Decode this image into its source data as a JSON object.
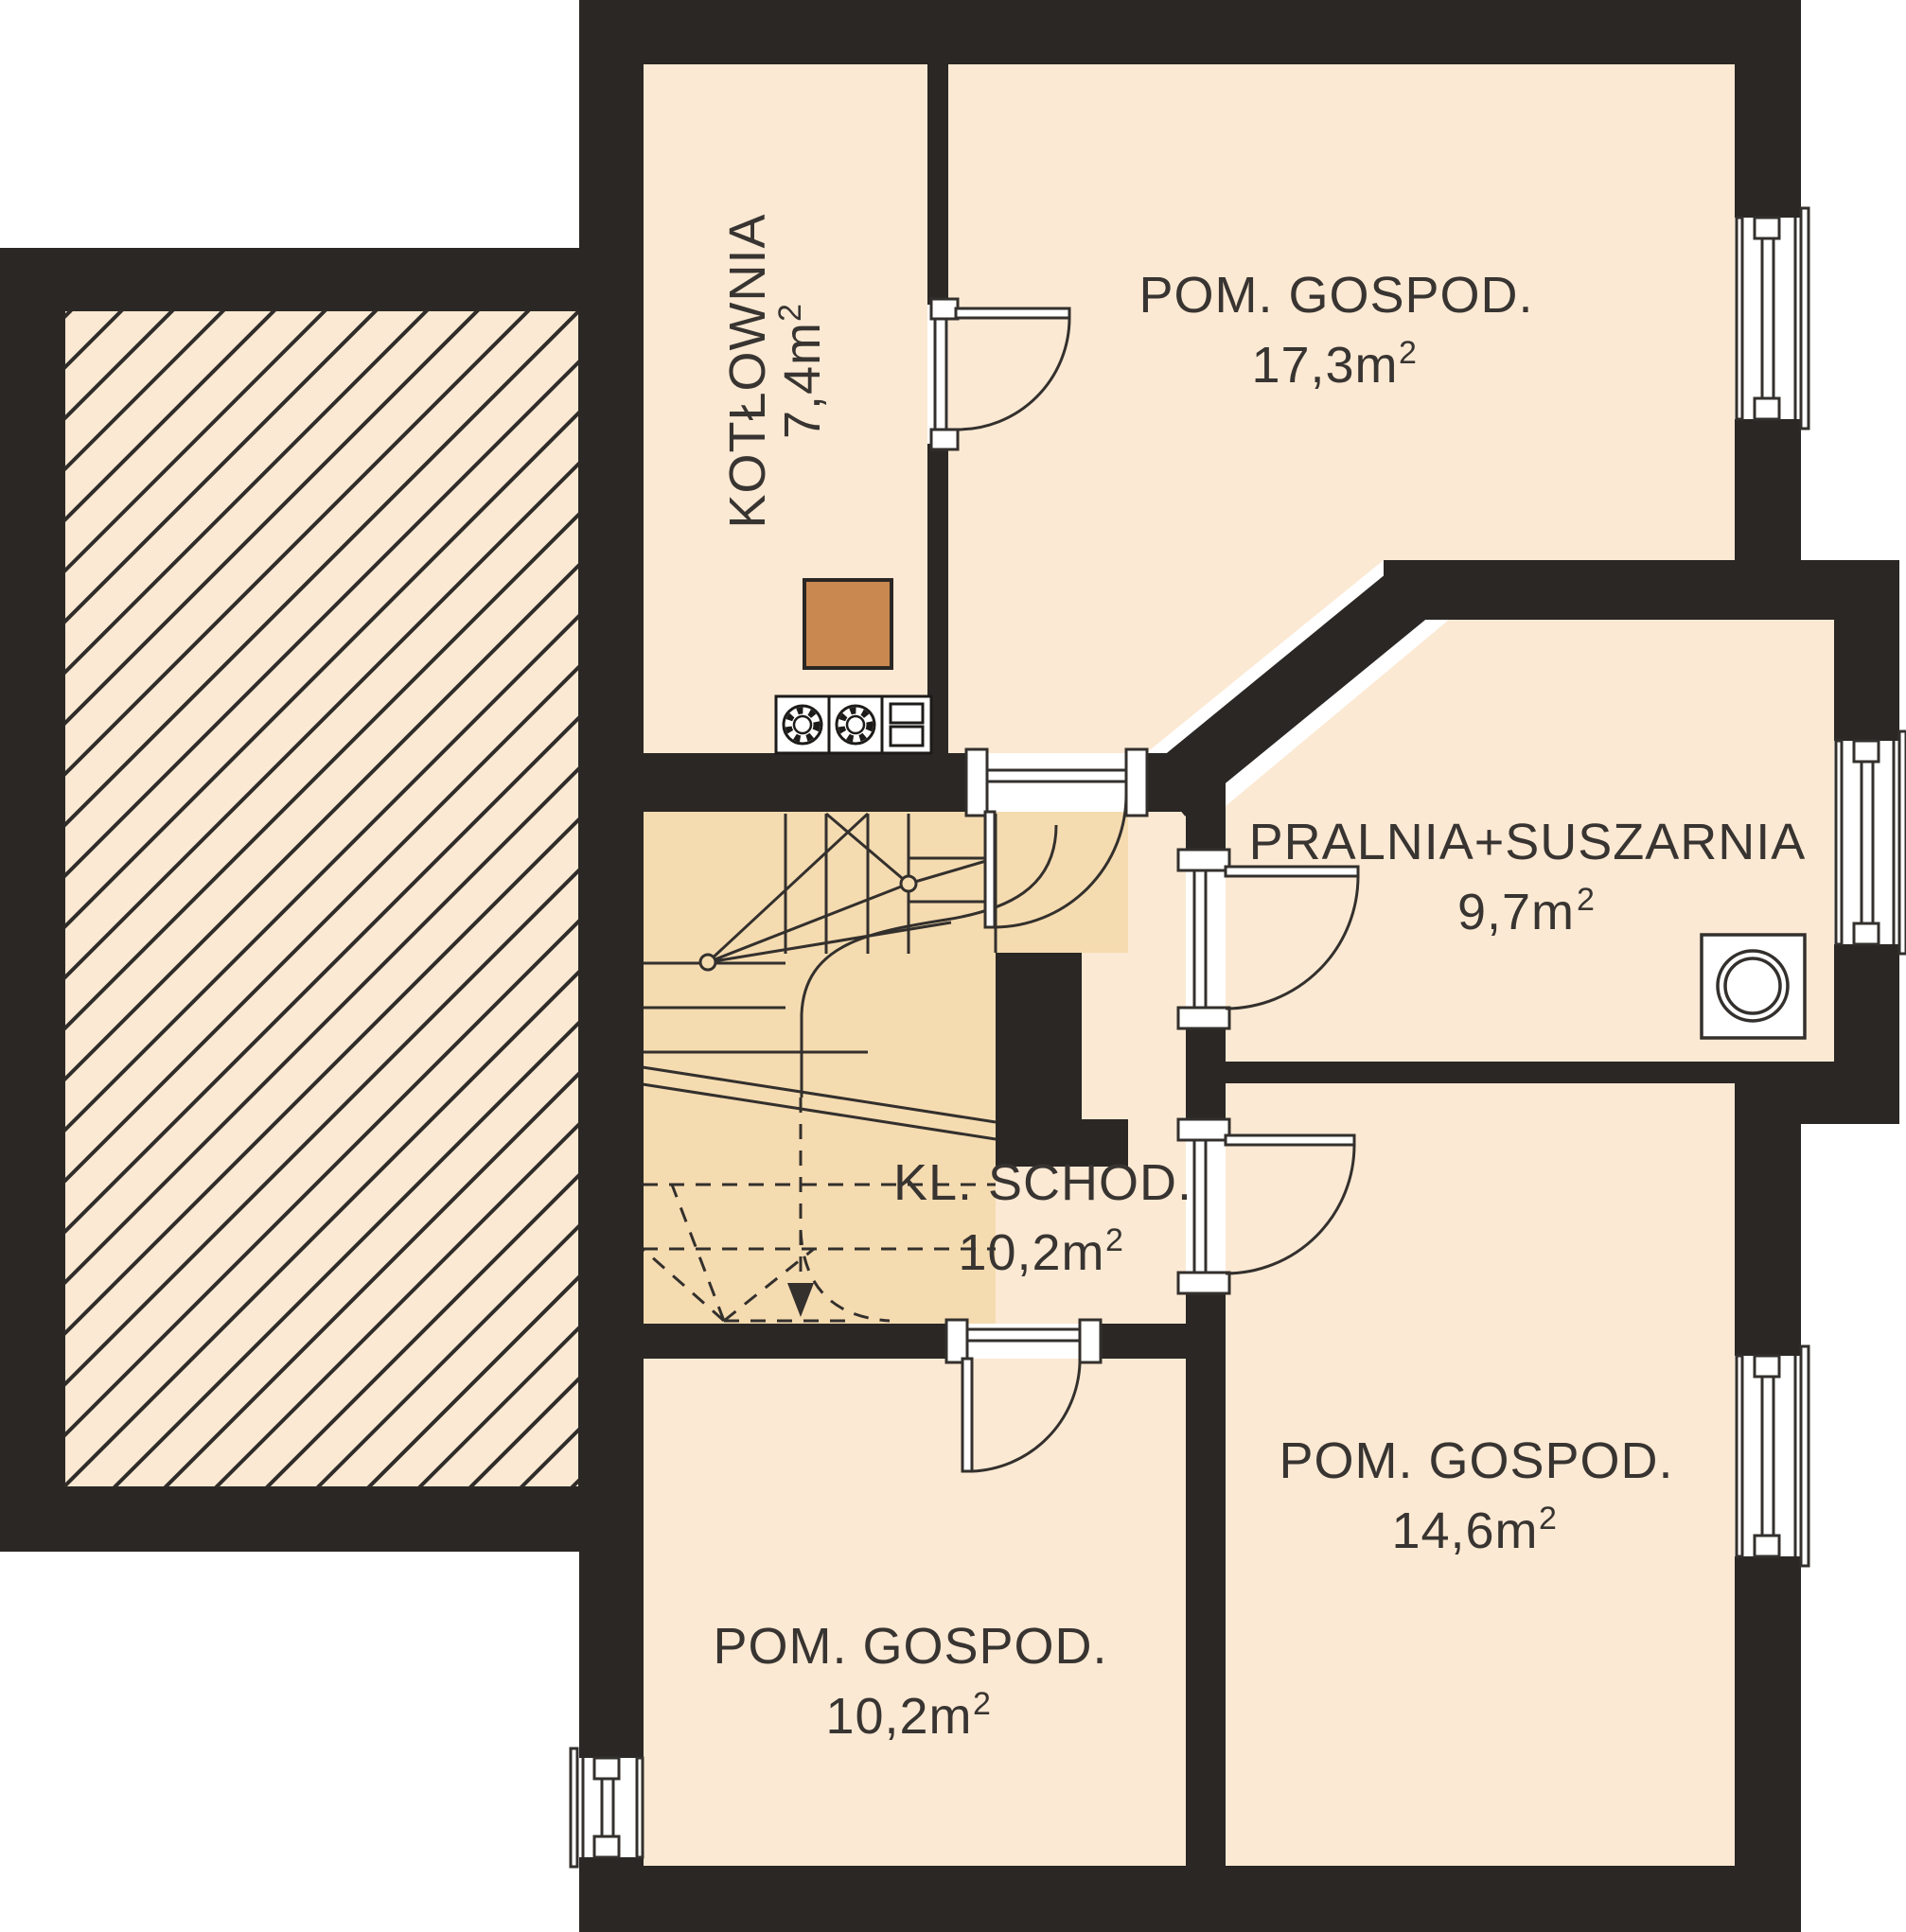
{
  "plan": {
    "type": "floor-plan",
    "language": "pl",
    "rooms": [
      {
        "name": "KOTŁOWNIA",
        "area": "7,4m",
        "sup": "2"
      },
      {
        "name": "POM. GOSPOD.",
        "area": "17,3m",
        "sup": "2"
      },
      {
        "name": "PRALNIA+SUSZARNIA",
        "area": "9,7m",
        "sup": "2"
      },
      {
        "name": "KL. SCHOD.",
        "area": "10,2m",
        "sup": "2"
      },
      {
        "name": "POM. GOSPOD.",
        "area": "14,6m",
        "sup": "2"
      },
      {
        "name": "POM. GOSPOD.",
        "area": "10,2m",
        "sup": "2"
      }
    ],
    "fixtures": [
      {
        "icon": "chimney-icon"
      },
      {
        "icon": "boiler-flue-icon"
      },
      {
        "icon": "boiler-flue-icon"
      },
      {
        "icon": "vent-grille-icon"
      },
      {
        "icon": "washing-machine-icon"
      },
      {
        "icon": "stairs-walk-arrow-icon"
      }
    ],
    "counts": {
      "windows": 4,
      "doors": 5
    },
    "palette": {
      "wall": "#2a2724",
      "floor": "#fce9d3",
      "stairs": "#f5dbb0",
      "chimney": "#c9884f",
      "line": "#33302d",
      "text": "#383431",
      "background": "#ffffff"
    }
  }
}
